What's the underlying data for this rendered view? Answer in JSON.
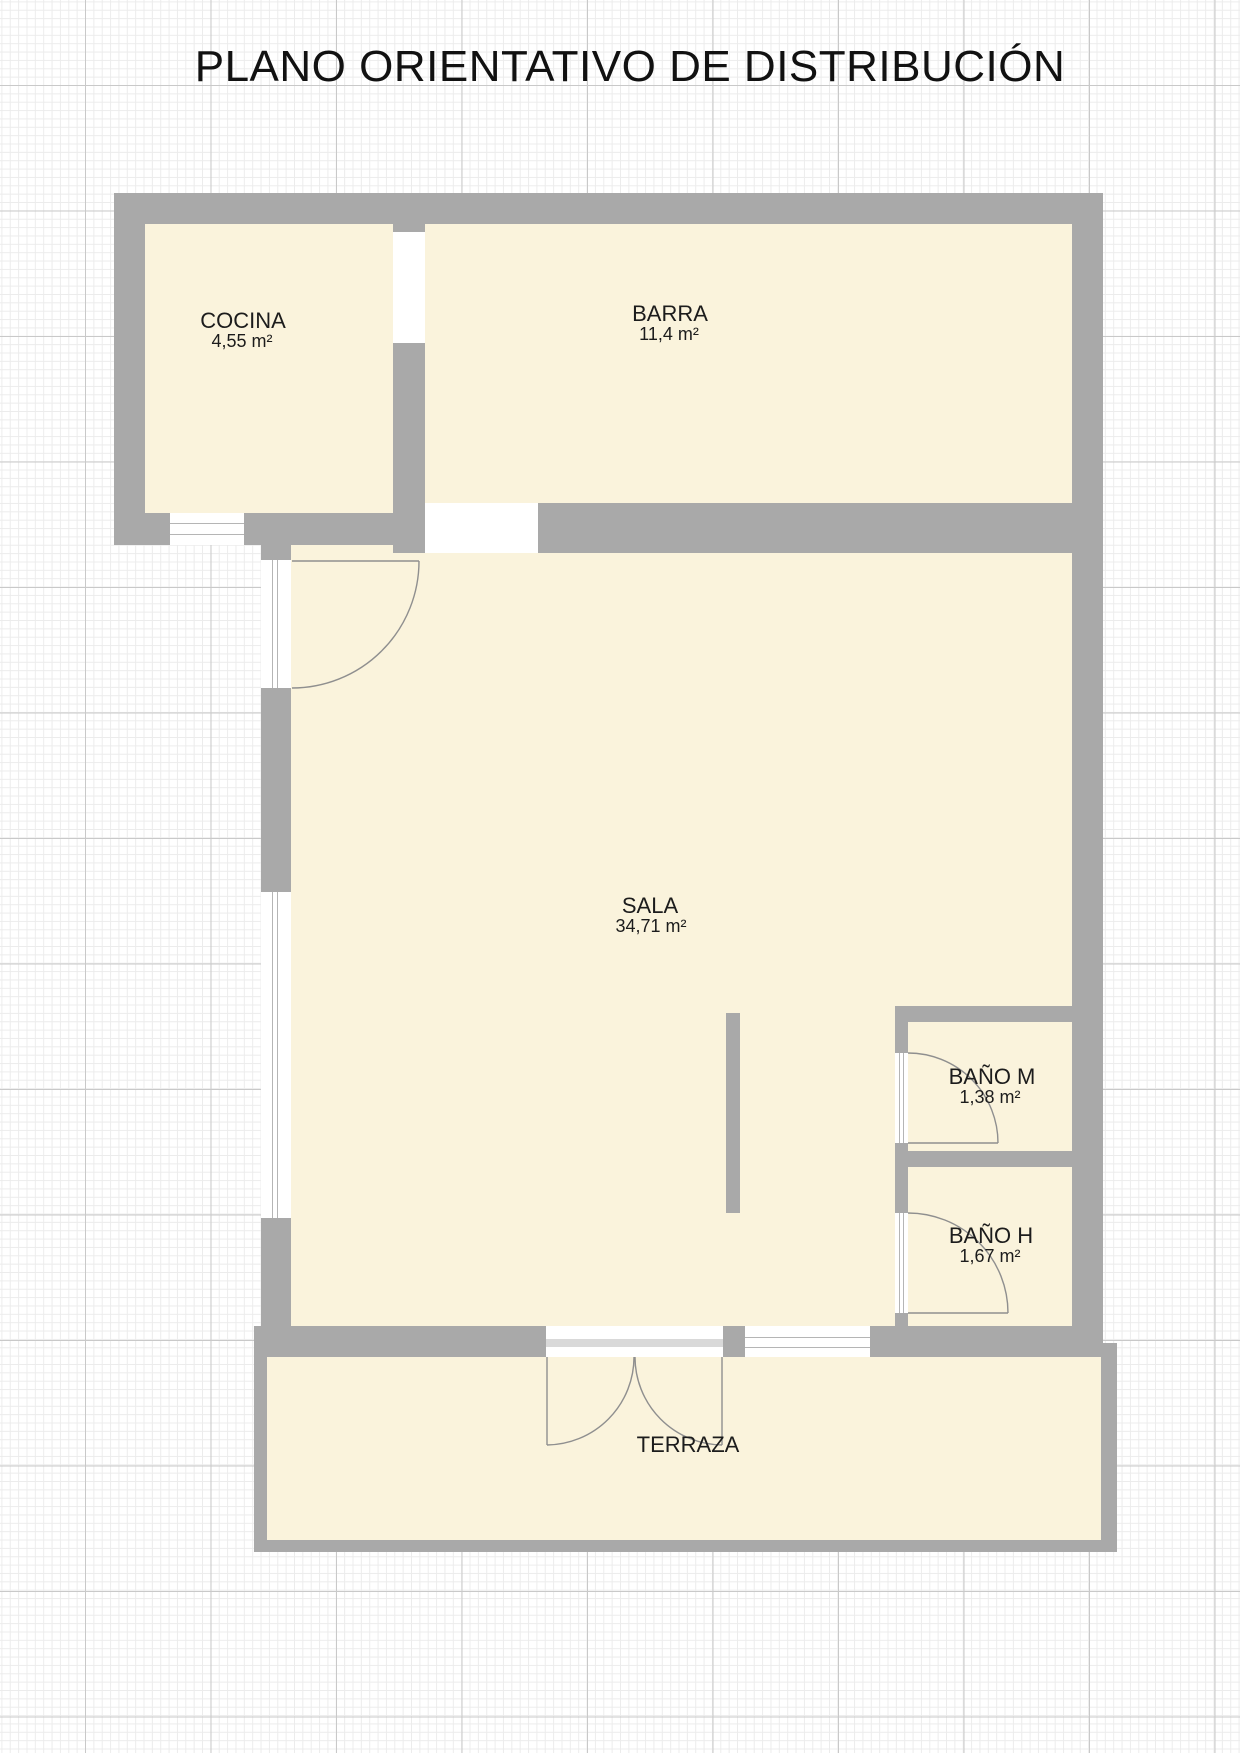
{
  "title": "PLANO ORIENTATIVO DE DISTRIBUCIÓN",
  "plan": {
    "rooms": [
      {
        "id": "cocina",
        "name": "COCINA",
        "area": "4,55 m²"
      },
      {
        "id": "barra",
        "name": "BARRA",
        "area": "11,4 m²"
      },
      {
        "id": "sala",
        "name": "SALA",
        "area": "34,71 m²"
      },
      {
        "id": "bano-m",
        "name": "BAÑO M",
        "area": "1,38 m²"
      },
      {
        "id": "bano-h",
        "name": "BAÑO H",
        "area": "1,67 m²"
      },
      {
        "id": "terraza",
        "name": "TERRAZA",
        "area": ""
      }
    ],
    "colors": {
      "wall": "#a9a9a9",
      "floor": "#faf3dc",
      "opening_line": "#b5b5b5"
    }
  }
}
